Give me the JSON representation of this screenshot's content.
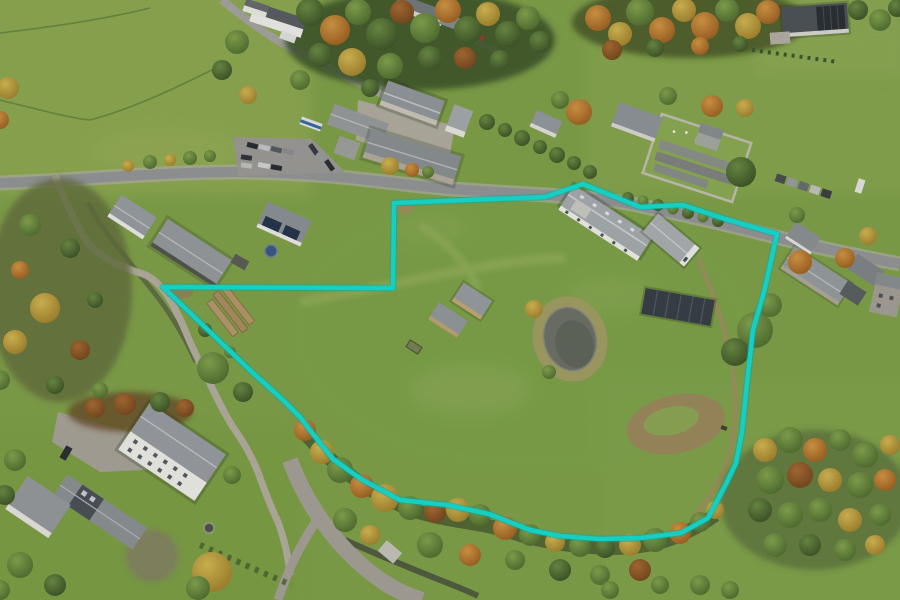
{
  "overlay": {
    "boundary_points": "163,287 393,288 394,203 545,197 583,184 640,207 683,205 725,219 777,234 764,292 753,330 747,383 742,432 736,463 726,484 708,518 681,533 640,538 600,539 560,536 530,530 489,514 447,505 400,500 361,479 333,459 313,434 300,417 283,400 253,373 163,287",
    "boundary_color": "#14cfc2",
    "glow_color": "#0ca79c",
    "stroke_width": "4.5"
  },
  "colors": {
    "grass_base": "#83a44c",
    "grass_light": "#9db75f",
    "road_asphalt": "#97989a",
    "lane_gravel": "#b6b1a2",
    "dirt": "#a0895f",
    "pond_water": "#70746a",
    "roof_gray": "#a3a8ac",
    "wall_white": "#f3f3f0",
    "solar_panel": "#3b4149",
    "tree_green": "#4c6a2f",
    "tree_orange": "#c07a2e",
    "tree_yellow": "#c6a53f"
  }
}
